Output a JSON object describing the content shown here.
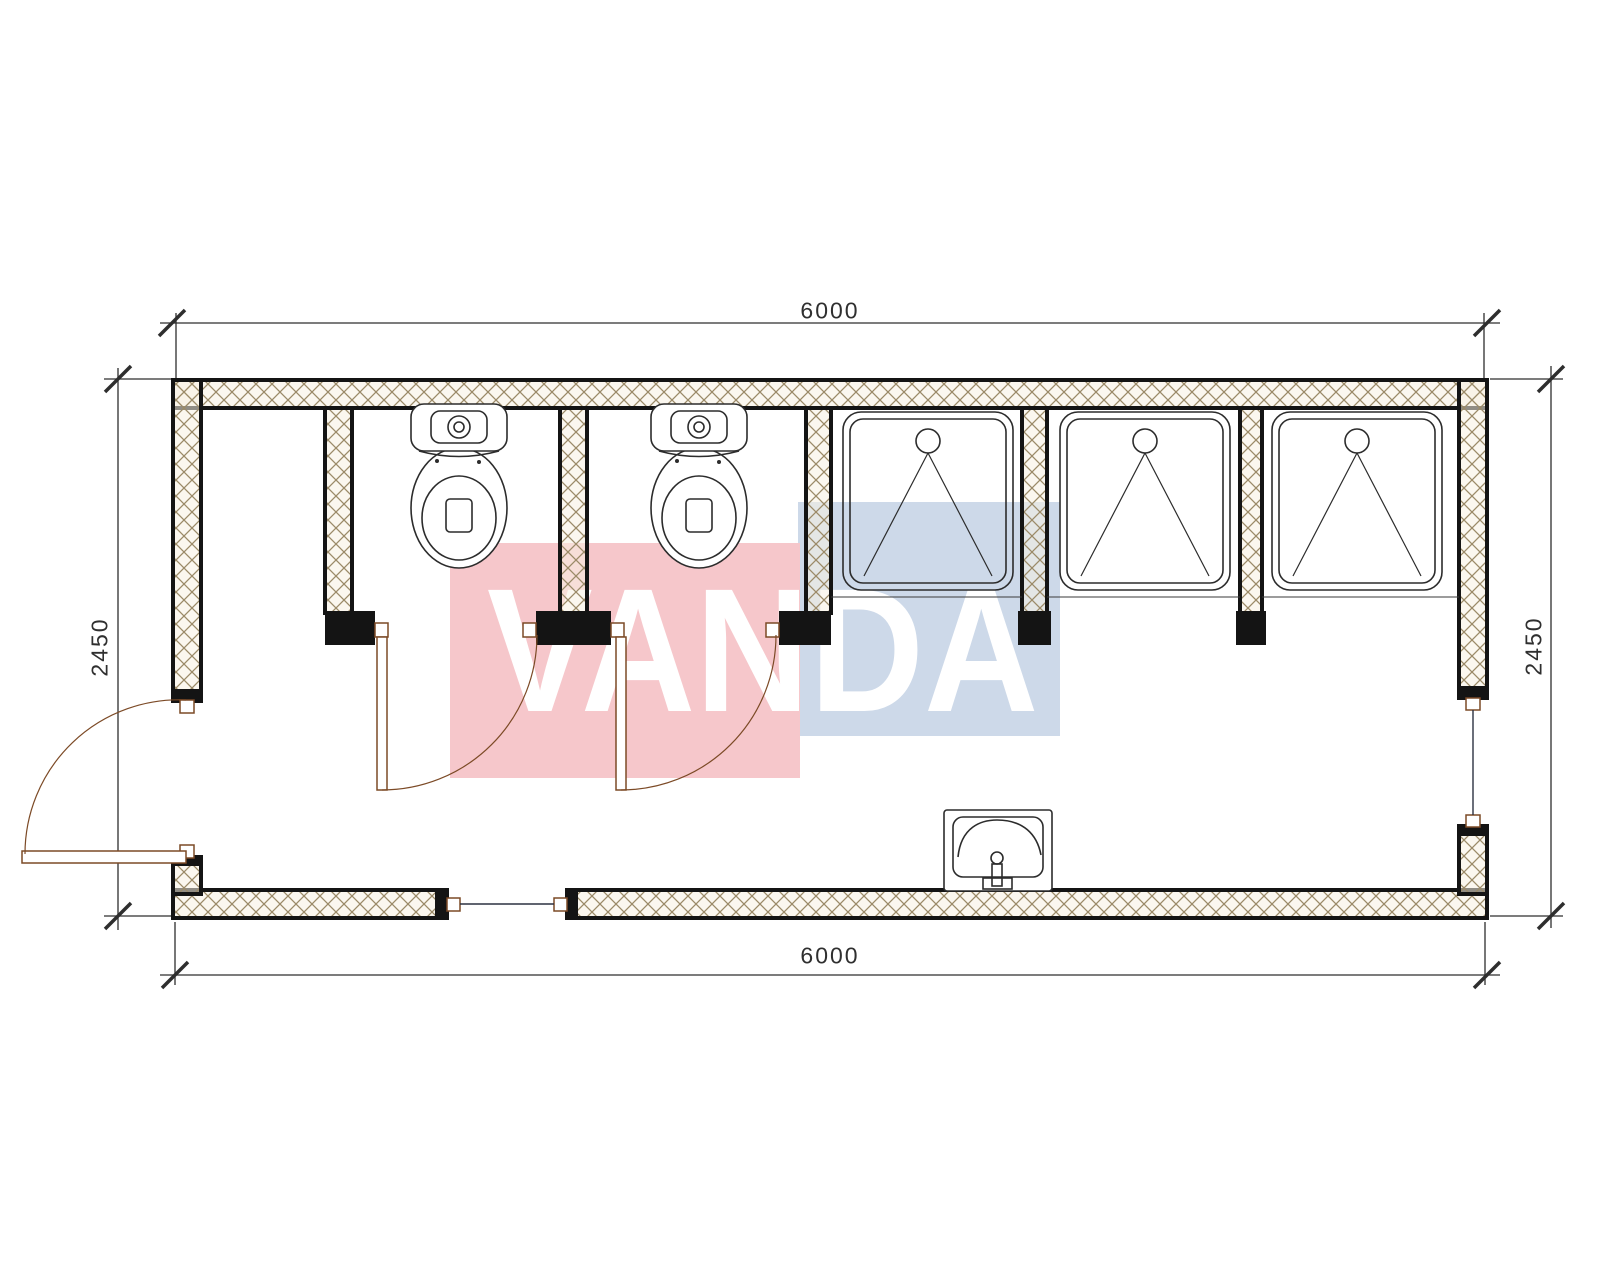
{
  "drawing": {
    "type": "architectural floor plan of sanitary container module",
    "dimensions": {
      "top": "6000",
      "bottom": "6000",
      "left": "2450",
      "right": "2450"
    },
    "watermark": {
      "text": "VANDA",
      "pink_color": "#f6c7cb",
      "blue_color": "#cdd9e9",
      "text_color": "#ffffff"
    },
    "style": {
      "wall_line_color": "#141414",
      "hatch_line_color": "#9b8a68",
      "hatch_fill_color": "#f7f0e1",
      "fixture_line_color": "#2c2c2c",
      "door_line_color": "#7c4a26",
      "dimension_line_color": "#2e2e2e"
    },
    "contents": {
      "toilet_stalls": 2,
      "shower_stalls": 3,
      "washbasins": 1,
      "swing_doors": 3
    }
  }
}
